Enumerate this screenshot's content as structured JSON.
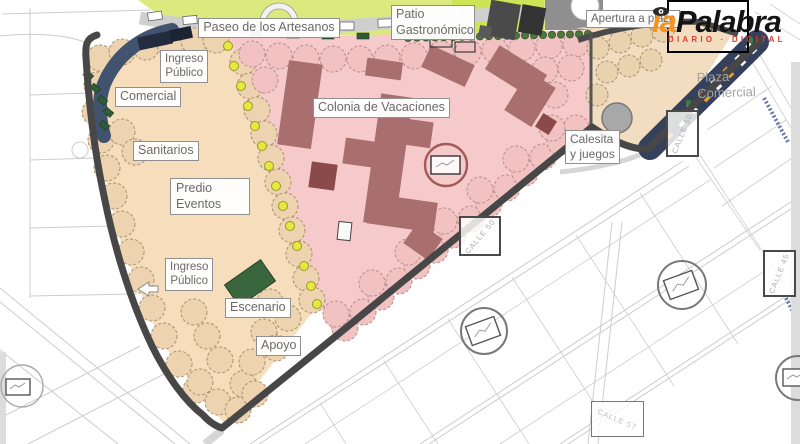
{
  "logo": {
    "brand_first": "la",
    "brand_rest": "Palabra",
    "tagline": "DIARIO · DIGITAL",
    "colors": {
      "first": "#f6921e",
      "rest": "#141414",
      "tagline": "#e03a2a"
    }
  },
  "map": {
    "zone_labels": [
      {
        "id": "paseo-artesanos",
        "text": "Paseo de los Artesanos"
      },
      {
        "id": "patio-gastronomico",
        "text": "Patio\nGastronómico"
      },
      {
        "id": "apertura-plaza",
        "text": "Apertura a plaza"
      },
      {
        "id": "ingreso-publico-norte",
        "text": "Ingreso\nPúblico"
      },
      {
        "id": "comercial",
        "text": "Comercial"
      },
      {
        "id": "sanitarios",
        "text": "Sanitarios"
      },
      {
        "id": "predio-eventos",
        "text": "Predio\nEventos"
      },
      {
        "id": "colonia-vacaciones",
        "text": "Colonia de Vacaciones"
      },
      {
        "id": "calesita-juegos",
        "text": "Calesita\ny juegos"
      },
      {
        "id": "ingreso-publico-sur",
        "text": "Ingreso\nPúblico"
      },
      {
        "id": "escenario",
        "text": "Escenario"
      },
      {
        "id": "apoyo",
        "text": "Apoyo"
      },
      {
        "id": "plaza-comercial",
        "text": "Plaza\nComercial"
      }
    ],
    "street_labels": [
      {
        "id": "calle-50-a",
        "text": "CALLE 50"
      },
      {
        "id": "calle-50-b",
        "text": "CALLE 50"
      },
      {
        "id": "calle-57",
        "text": "CALLE 57"
      },
      {
        "id": "calle-45",
        "text": "CALLE 45"
      }
    ],
    "legend_colors": {
      "colonia_zone": "#f6caca",
      "predio_zone": "#f6ddbb",
      "buildings": "#a96e6e",
      "paseo_green": "#dbe97f",
      "park_border": "#474747",
      "access_navy": "#41536e"
    }
  }
}
